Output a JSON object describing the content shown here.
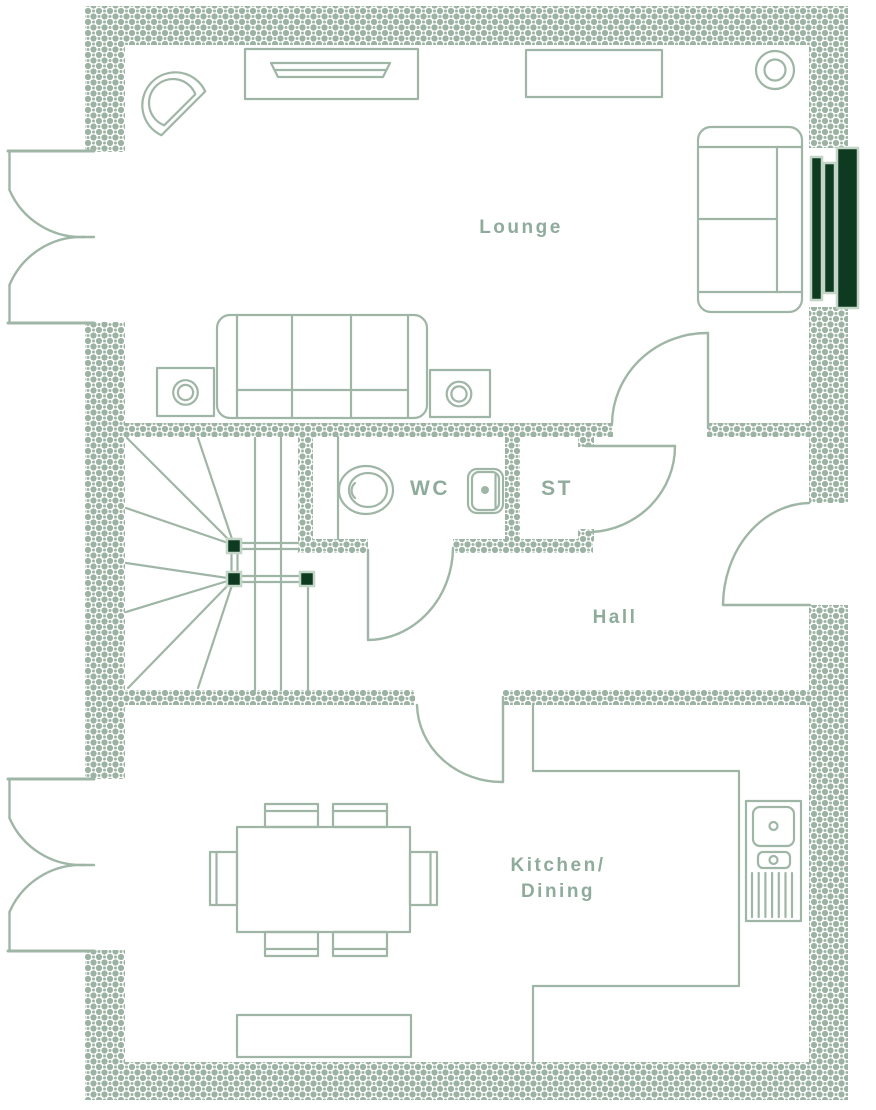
{
  "document": {
    "kind": "architectural-floor-plan",
    "style": "sage-outline developer floorplan"
  },
  "colors": {
    "background": "#ffffff",
    "wall_pattern": "#9cb3a4",
    "outline": "#9fb6a7",
    "label_text": "#8fab9c",
    "accent_dark_green": "#0e3a21",
    "accent_light_border": "#c3d5c6"
  },
  "labels": {
    "lounge": "Lounge",
    "wc": "WC",
    "store": "ST",
    "hall": "Hall",
    "kitchen_line1": "Kitchen/",
    "kitchen_line2": "Dining"
  },
  "rooms": [
    {
      "id": "lounge",
      "label": "Lounge"
    },
    {
      "id": "wc",
      "label": "WC"
    },
    {
      "id": "store",
      "label": "ST"
    },
    {
      "id": "hall",
      "label": "Hall"
    },
    {
      "id": "kitchen-dining",
      "label": "Kitchen/ Dining"
    }
  ],
  "furniture_symbols": {
    "lounge": [
      "armchair",
      "tv-unit",
      "sideboard",
      "floor-lamp",
      "two-seat-sofa",
      "three-seat-sofa",
      "side-table-lamp-left",
      "side-table-lamp-right",
      "feature-window-panels"
    ],
    "wc": [
      "toilet",
      "basin"
    ],
    "stairs": [
      "winder-staircase",
      "newel-posts-x3",
      "handrails"
    ],
    "kitchen_dining": [
      "dining-table",
      "dining-chairs-x6",
      "bench",
      "sink-unit-with-drainer"
    ],
    "doors": [
      "lounge-french-doors",
      "kitchen-french-doors",
      "lounge-hall-door",
      "wc-door",
      "store-door",
      "front-door",
      "kitchen-door"
    ]
  }
}
